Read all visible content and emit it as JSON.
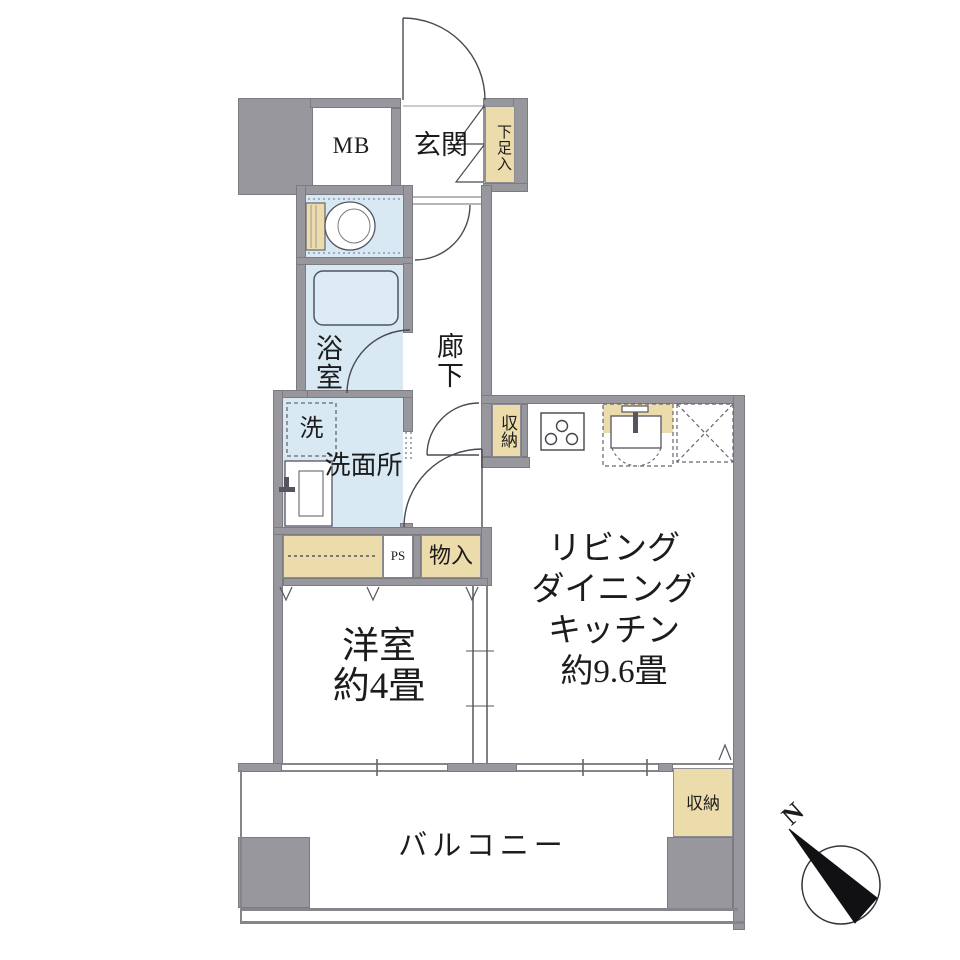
{
  "plan_title": "floor-plan",
  "rooms": {
    "mb": "MB",
    "entrance": "玄関",
    "shoe_box": "下足入",
    "hallway": "廊下",
    "bathroom": "浴室",
    "washer": "洗",
    "washroom": "洗面所",
    "hall_closet": "収納",
    "storage": "物入",
    "ps": "PS",
    "western_room": {
      "name": "洋室",
      "size": "約4畳"
    },
    "ldk": {
      "line1": "リビング",
      "line2": "ダイニング",
      "line3": "キッチン",
      "size": "約9.6畳"
    },
    "balcony": "バルコニー",
    "balcony_closet": "収納"
  },
  "compass": {
    "north": "N"
  },
  "colors": {
    "wall": "#97979d",
    "wet_room_fill": "#d9e9f4",
    "storage_fill": "#eddcab",
    "line": "#4a4a52",
    "background": "#ffffff"
  }
}
